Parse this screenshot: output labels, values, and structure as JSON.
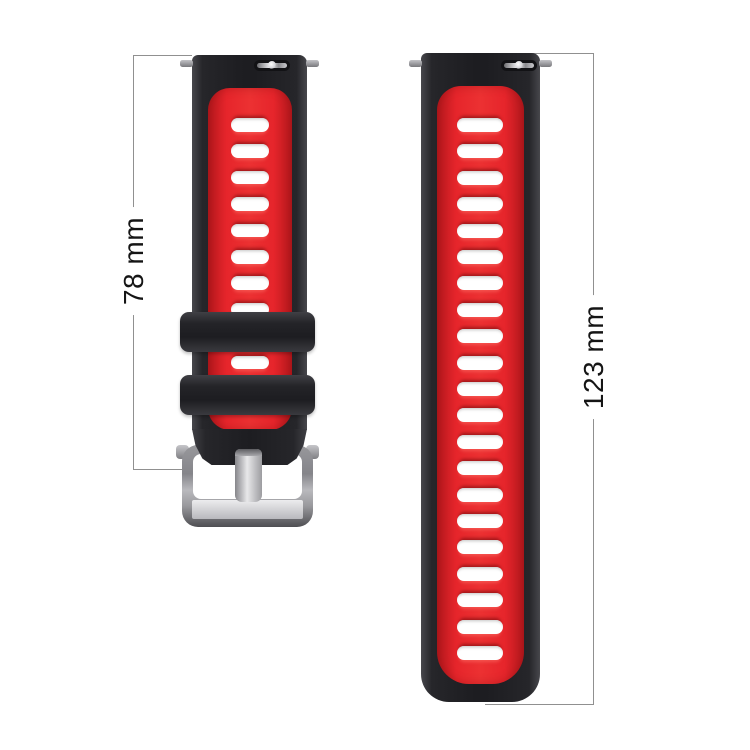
{
  "figure": {
    "description": "Two-piece black and red silicone watch strap, shown vertically with dimension lines",
    "background": "#ffffff"
  },
  "annotations": {
    "left": {
      "label": "78 mm",
      "value": 78,
      "unit": "mm",
      "measures": "short strap with buckle"
    },
    "right": {
      "label": "123 mm",
      "value": 123,
      "unit": "mm",
      "measures": "long strap"
    }
  },
  "product": {
    "colors": {
      "strap_black": "#1d1d21",
      "strap_black_highlight": "#47474c",
      "strap_red": "#e6252b",
      "strap_red_dark": "#b5181d",
      "slot_white": "#ffffff",
      "buckle_silver": "#b9b9bd",
      "buckle_silver_dark": "#4e4e52",
      "dimension_line": "#909090",
      "label_text": "#151515",
      "background": "#ffffff"
    },
    "short_strap": {
      "slot_rows": 11,
      "keeper_count": 2,
      "has_buckle": true,
      "has_spring_bar": true
    },
    "long_strap": {
      "slot_rows": 21,
      "keeper_count": 0,
      "has_buckle": false,
      "has_spring_bar": true
    }
  }
}
